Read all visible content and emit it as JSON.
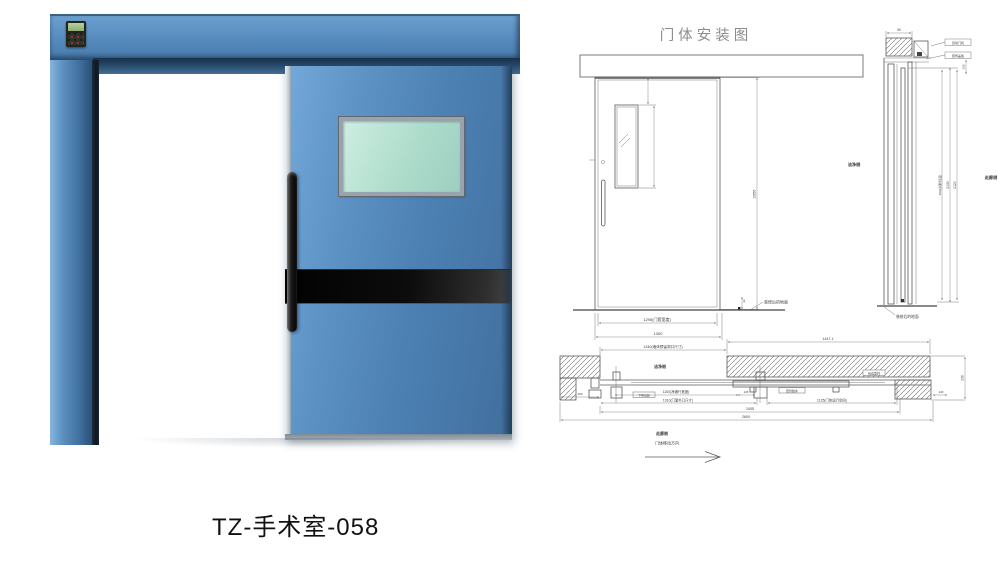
{
  "colors": {
    "door_blue": "#4f83b7",
    "frame_blue": "#4a7aa8",
    "glass_mint": "#aedccb",
    "kick_band_black": "#0d0d0d",
    "drawing_line_gray": "#5a5a5a",
    "title_gray": "#8d8d8d"
  },
  "caption": {
    "model": "TZ-手术室-058"
  },
  "drawing": {
    "title": "门体安装图",
    "elevation": {
      "dim_height": "2056",
      "dim_frame_width": "1295(门套宽度)",
      "dim_total_width": "1300",
      "dim_floor_gap": "22",
      "floor_label": "装修后的地面"
    },
    "section": {
      "dim_top": "50",
      "dim_side_gap": "165",
      "dim_clear": "2050(净通行高度)",
      "dim_h_track": "2130",
      "dim_h_leaf": "2120",
      "side_left": "洁净侧",
      "side_right": "走廊侧",
      "floor_label": "装修后的地面",
      "callout_top": "自动门机",
      "callout_mid": "装饰盖板"
    },
    "plan": {
      "dim_opening": "1340(墙体预留洞口尺寸)",
      "dim_pocket": "1447.1",
      "dim_clear": "1100(净通行宽度)",
      "dim_frame": "1310(门套外口尺寸)",
      "dim_travel": "1125(门体运行空间)",
      "dim_total_inner": "2405",
      "dim_total_outer": "2600",
      "dim_wall_left": "160",
      "dim_gap": "125",
      "dim_wall_right": "230",
      "dim_end": "140",
      "side_top": "洁净侧",
      "side_bottom": "走廊侧",
      "direction_label": "门体移动方向",
      "callout_guide": "下导向轮",
      "callout_seal": "密封胶条",
      "callout_edge": "包边型材"
    }
  }
}
